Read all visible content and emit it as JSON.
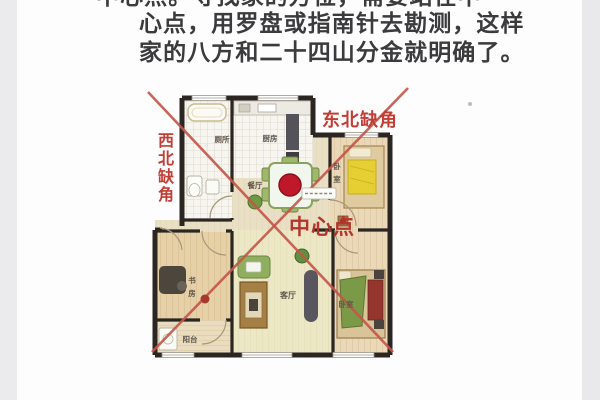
{
  "page": {
    "background": "#fdfdfe",
    "edge_strip": "#ebebee"
  },
  "article": {
    "text_color": "#3b3b3d",
    "lines": [
      "中心点。寻找家的方位，需要站在中",
      "心点，用罗盘或指南针去勘测，这样",
      "家的八方和二十四山分金就明确了。"
    ]
  },
  "floorplan": {
    "annotations": {
      "northwest_missing": "西北缺角",
      "northeast_missing": "东北缺角",
      "center_point": "中心点",
      "color": "#c23d33"
    },
    "rooms": {
      "bathroom": "厕所",
      "kitchen": "厨房",
      "dining": "餐厅",
      "bedroom_ne": "卧室",
      "study": "书房",
      "balcony": "阳台",
      "living": "客厅",
      "bedroom_se": "卧室"
    },
    "colors": {
      "wall": "#2c2623",
      "diagonal": "#c4564a",
      "center_dot": "#c0182b"
    }
  }
}
